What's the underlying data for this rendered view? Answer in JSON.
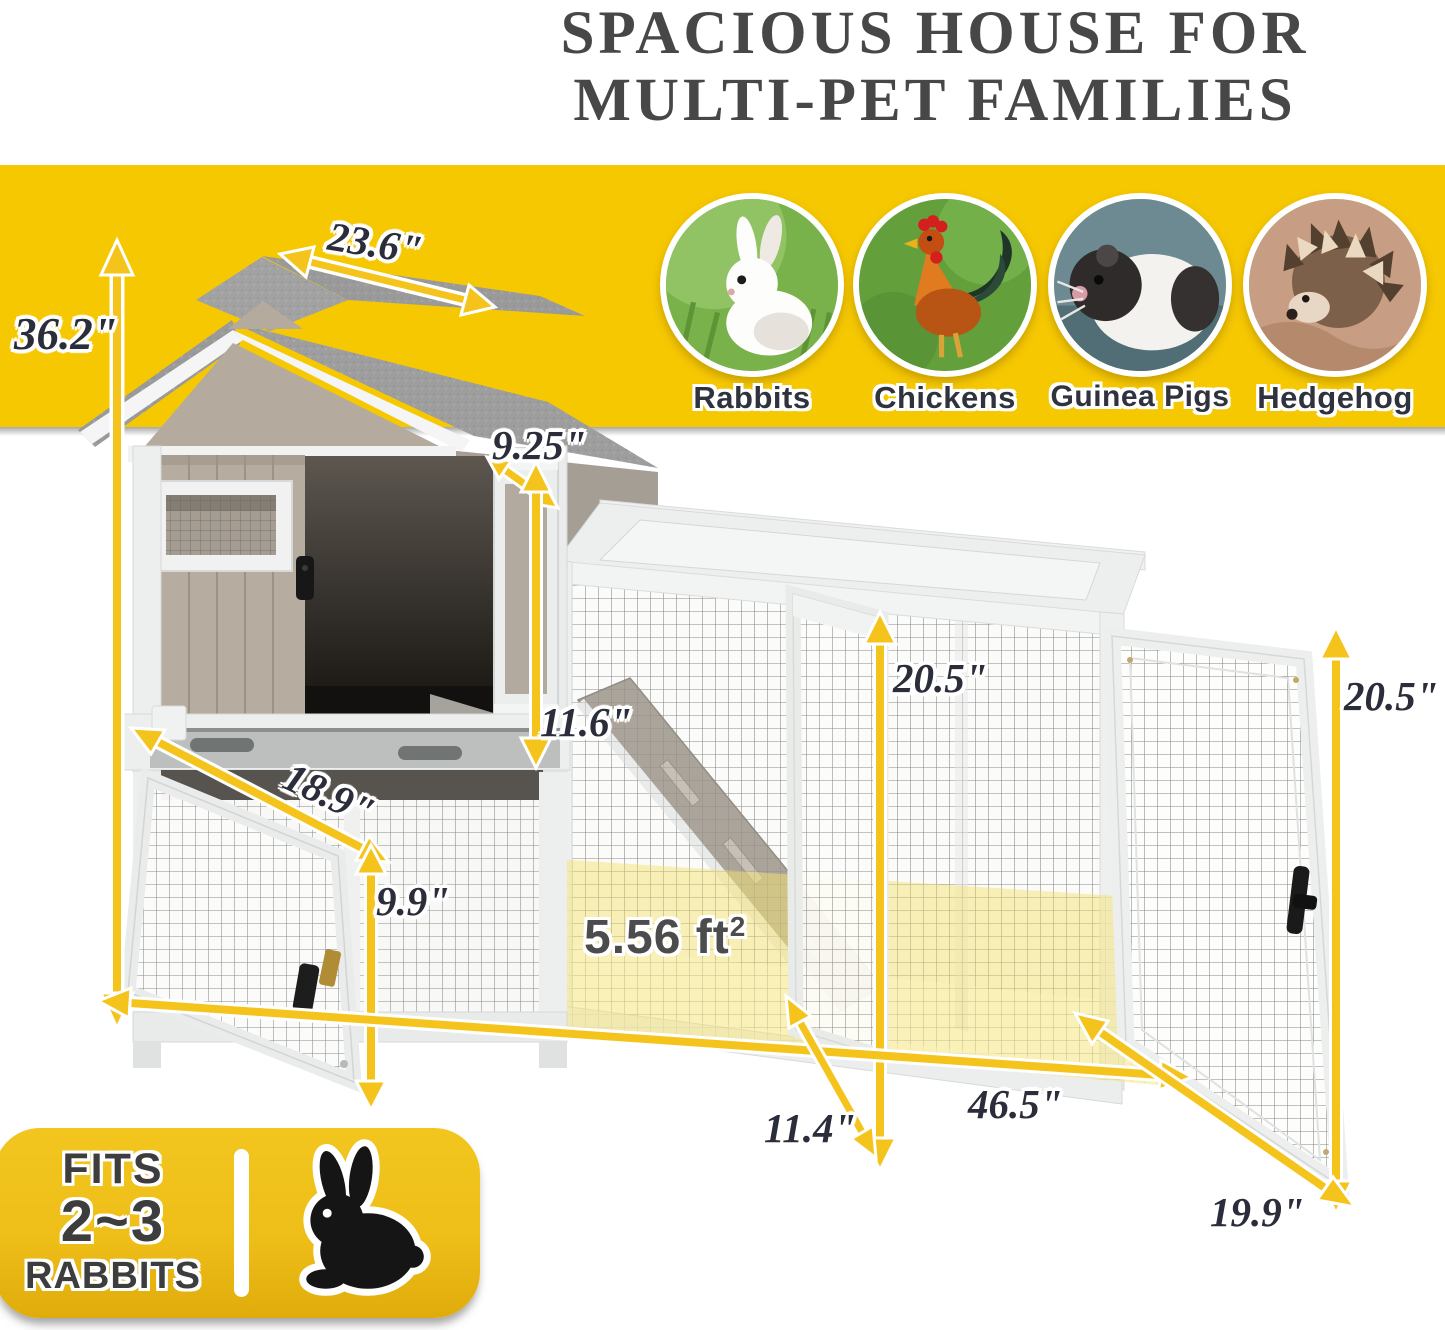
{
  "title": {
    "line1": "SPACIOUS HOUSE FOR",
    "line2": "MULTI-PET FAMILIES"
  },
  "pets": [
    {
      "label": "Rabbits"
    },
    {
      "label": "Chickens"
    },
    {
      "label": "Guinea Pigs"
    },
    {
      "label": "Hedgehog"
    }
  ],
  "dimensions": {
    "overall_height": "36.2\"",
    "roof_depth": "23.6\"",
    "house_door_width": "9.25\"",
    "house_inner_height": "11.6\"",
    "house_width": "18.9\"",
    "lower_height": "9.9\"",
    "run_inner_height": "20.5\"",
    "run_length": "46.5\"",
    "middle_door_width": "11.4\"",
    "right_door_height": "20.5\"",
    "right_door_width": "19.9\""
  },
  "area": {
    "value": "5.56 ft",
    "sup": "2"
  },
  "fits_badge": {
    "line1": "FITS",
    "line2": "2~3",
    "line3": "RABBITS"
  },
  "colors": {
    "band_yellow": "#F6C802",
    "arrow_yellow": "#F5C41C",
    "dimension_text": "#2B2E3A",
    "title_text": "#474747",
    "floor_highlight": "#F6E372",
    "badge_yellow": "#EFC11E",
    "roof_gray": "#9E9E9E",
    "siding_taupe": "#B6AC9F"
  }
}
